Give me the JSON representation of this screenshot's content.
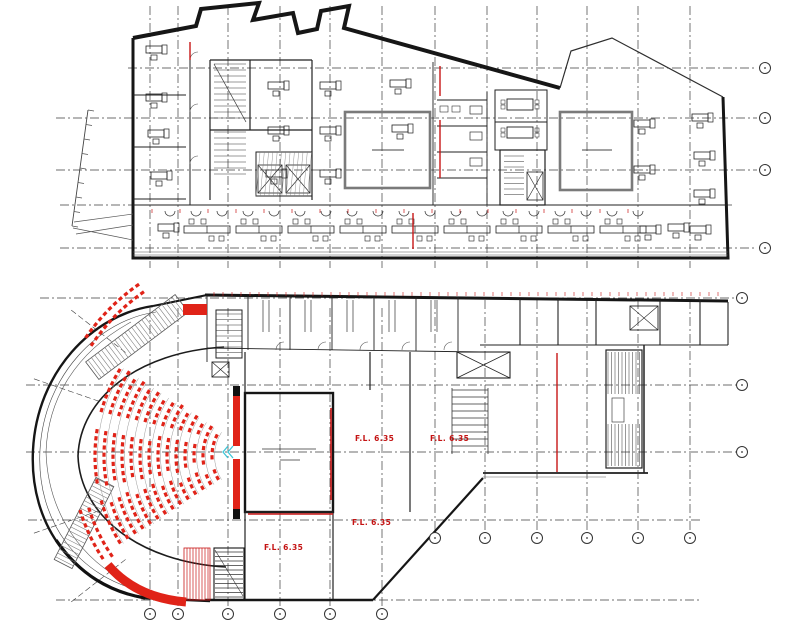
{
  "drawing": {
    "type": "architectural-floor-plans",
    "sheets": [
      "office-floor-plan",
      "theatre-floor-plan"
    ]
  },
  "colors": {
    "wall": "#161616",
    "thin": "#2e2e2e",
    "grid": "#3d3d3d",
    "gray": "#6e6e6e",
    "well": "#7a7a7a",
    "red": "#c81616",
    "seat_red": "#e02318",
    "cyan": "#3fc6d8"
  },
  "upper_plan": {
    "grid_columns_x": [
      150,
      178,
      228,
      280,
      330,
      382,
      435,
      487,
      537,
      587,
      638,
      690
    ],
    "grid_rows": [
      {
        "y": 68,
        "x1": 128,
        "x2": 757,
        "bubble": true
      },
      {
        "y": 118,
        "x1": 56,
        "x2": 757,
        "bubble": true
      },
      {
        "y": 170,
        "x1": 56,
        "x2": 757,
        "bubble": true
      },
      {
        "y": 205,
        "x1": 60,
        "x2": 732,
        "bubble": false
      },
      {
        "y": 248,
        "x1": 60,
        "x2": 757,
        "bubble": true
      }
    ],
    "right_bubbles": [
      [
        765,
        68
      ],
      [
        765,
        118
      ],
      [
        765,
        170
      ],
      [
        765,
        248
      ]
    ],
    "left_desks": [
      [
        146,
        46
      ],
      [
        146,
        94
      ],
      [
        148,
        130
      ],
      [
        151,
        172
      ]
    ],
    "center_desks": [
      [
        268,
        82
      ],
      [
        268,
        127
      ],
      [
        266,
        170
      ],
      [
        320,
        82
      ],
      [
        320,
        127
      ],
      [
        320,
        170
      ],
      [
        390,
        80
      ],
      [
        392,
        125
      ]
    ],
    "right_desks": [
      [
        634,
        120
      ],
      [
        692,
        114
      ],
      [
        634,
        166
      ],
      [
        694,
        152
      ],
      [
        694,
        190
      ],
      [
        640,
        226
      ],
      [
        690,
        226
      ]
    ],
    "bench_cluster_xs": [
      207,
      259,
      311,
      363,
      415,
      467,
      519,
      571,
      623
    ],
    "bench_y": 226,
    "red_wall_segments": [
      [
        413,
        213,
        413,
        249
      ],
      [
        440,
        66,
        440,
        96
      ],
      [
        440,
        120,
        440,
        178
      ],
      [
        190,
        42,
        190,
        60
      ]
    ],
    "red_tick_row": {
      "y": 209,
      "x_start": 152,
      "x_end": 648,
      "step": 28
    }
  },
  "lower_plan": {
    "grid_rows": [
      {
        "y": 298,
        "x1": 40,
        "x2": 736,
        "bubble": true
      },
      {
        "y": 385,
        "x1": 26,
        "x2": 736,
        "bubble": true
      },
      {
        "y": 452,
        "x1": 26,
        "x2": 736,
        "bubble": true
      },
      {
        "y": 520,
        "x1": 28,
        "x2": 700,
        "bubble": false
      },
      {
        "y": 600,
        "x1": 56,
        "x2": 700,
        "bubble": false
      }
    ],
    "bottom_bubbles": [
      [
        150,
        614
      ],
      [
        178,
        614
      ],
      [
        228,
        614
      ],
      [
        280,
        614
      ],
      [
        330,
        614
      ],
      [
        382,
        614
      ]
    ],
    "mid_bubbles": [
      [
        435,
        538
      ],
      [
        485,
        538
      ],
      [
        537,
        538
      ],
      [
        587,
        538
      ],
      [
        638,
        538
      ],
      [
        690,
        538
      ]
    ],
    "right_bubbles": [
      [
        742,
        298
      ],
      [
        742,
        385
      ],
      [
        742,
        452
      ]
    ],
    "long_columns_x": [
      150,
      178,
      228,
      280,
      330,
      382
    ],
    "short_columns_x": [
      435,
      485,
      537,
      587,
      638,
      690
    ],
    "level_labels": [
      {
        "text": "F.L. 6.35",
        "x": 355,
        "y": 441
      },
      {
        "text": "F.L. 6.35",
        "x": 430,
        "y": 441
      },
      {
        "text": "F.L. 6.35",
        "x": 352,
        "y": 525
      },
      {
        "text": "F.L. 6.35",
        "x": 264,
        "y": 550
      }
    ],
    "seating": {
      "cx": 258,
      "cy": 456,
      "radii": [
        46,
        55,
        64,
        73,
        82,
        91,
        100,
        109,
        118,
        127,
        136,
        145,
        154,
        163
      ],
      "span_deg": 66,
      "seat_step_px": 7.2,
      "aisle_offsets_deg": [
        -13,
        13
      ],
      "aisle_half_deg": 2.6,
      "balcony_rows": [
        {
          "r": 200,
          "a1": 214,
          "a2": 236
        },
        {
          "r": 209,
          "a1": 215,
          "a2": 235
        },
        {
          "r": 177,
          "a1": 146,
          "a2": 164
        },
        {
          "r": 186,
          "a1": 147,
          "a2": 163
        }
      ]
    },
    "radial_grid_deg": [
      142,
      161,
      199,
      218
    ],
    "red_top_ticks": {
      "y": 292,
      "x_start": 214,
      "x_end": 724,
      "step": 9
    }
  }
}
